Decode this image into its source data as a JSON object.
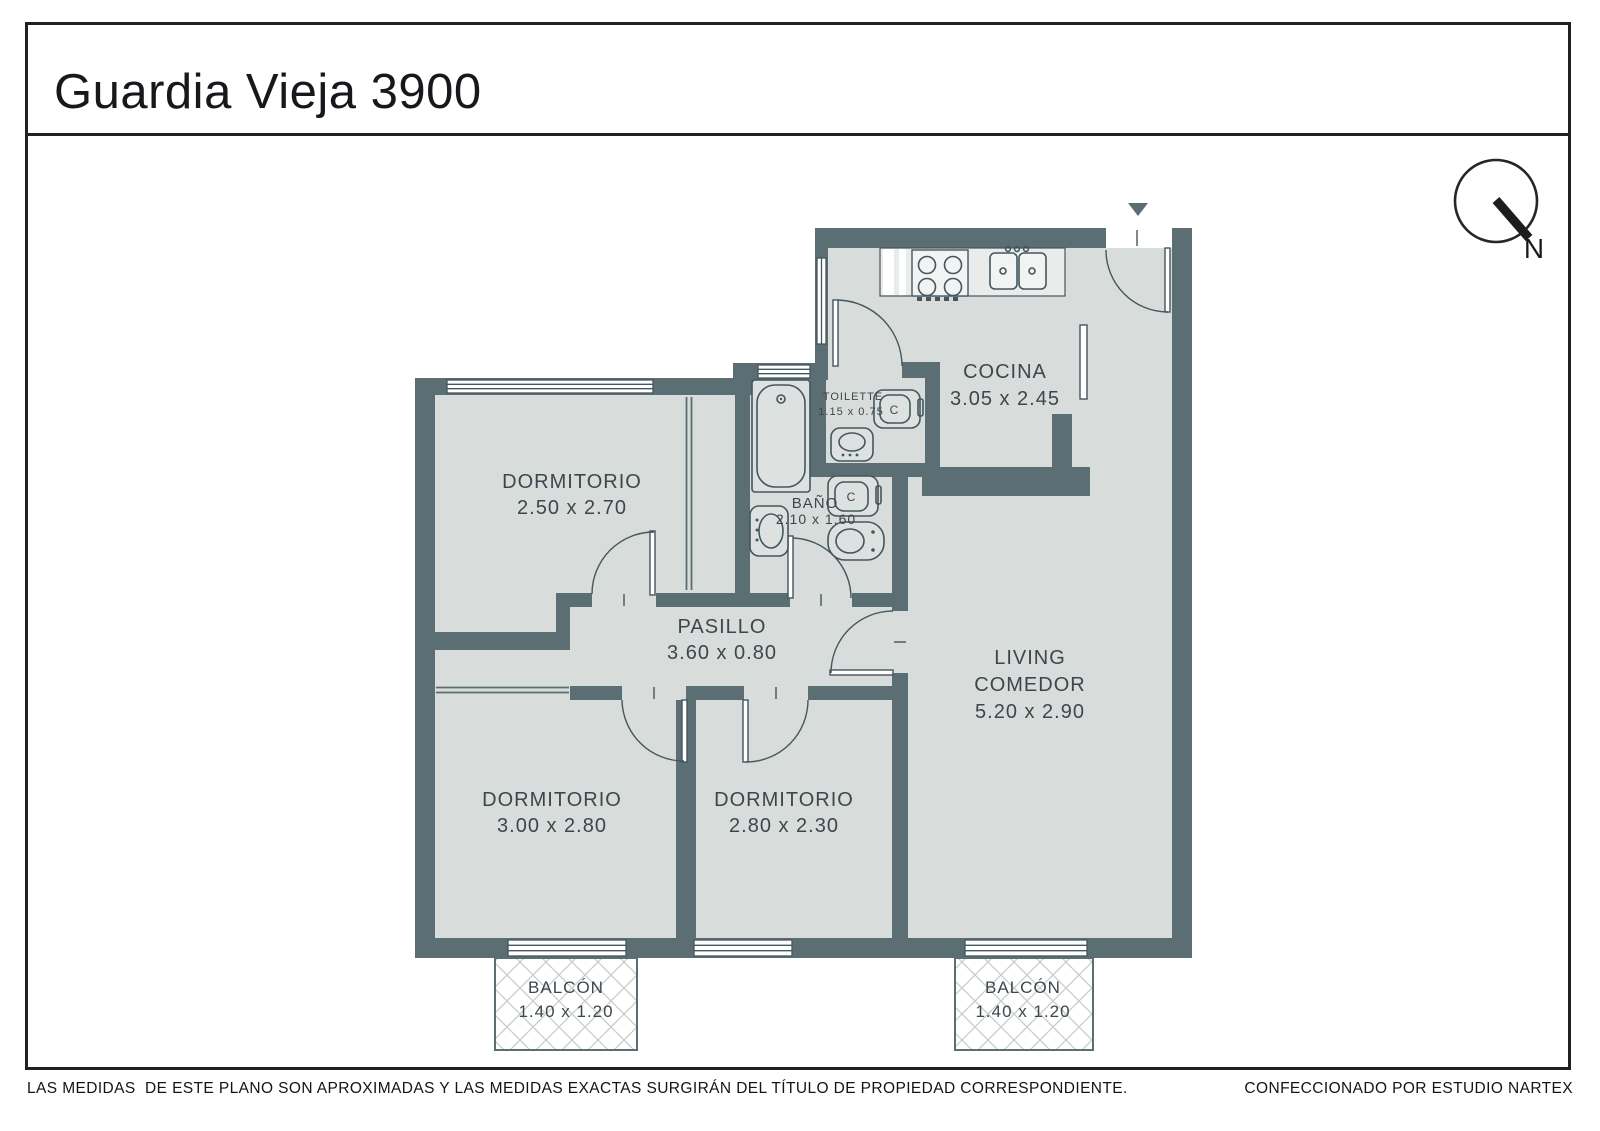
{
  "header": {
    "title": "Guardia Vieja 3900"
  },
  "compass": {
    "north_label": "N"
  },
  "plan": {
    "rooms": {
      "dormitorio_1": {
        "name": "DORMITORIO",
        "dims": "2.50 x 2.70"
      },
      "cocina": {
        "name": "COCINA",
        "dims": "3.05 x 2.45"
      },
      "toilette": {
        "name": "TOILETTE",
        "dims": "1.15 x 0.75"
      },
      "bano": {
        "name": "BAÑO",
        "dims": "2.10 x 1.60"
      },
      "pasillo": {
        "name": "PASILLO",
        "dims": "3.60 x 0.80"
      },
      "living_comedor": {
        "name_line1": "LIVING",
        "name_line2": "COMEDOR",
        "dims": "5.20 x 2.90"
      },
      "dormitorio_2": {
        "name": "DORMITORIO",
        "dims": "3.00 x 2.80"
      },
      "dormitorio_3": {
        "name": "DORMITORIO",
        "dims": "2.80 x 2.30"
      },
      "balcon_left": {
        "name": "BALCÓN",
        "dims": "1.40 x 1.20"
      },
      "balcon_right": {
        "name": "BALCÓN",
        "dims": "1.40 x 1.20"
      }
    },
    "fixtures": {
      "toilet_marker": "C"
    }
  },
  "footer": {
    "disclaimer": "LAS MEDIDAS  DE ESTE PLANO SON APROXIMADAS Y LAS MEDIDAS EXACTAS SURGIRÁN DEL TÍTULO DE PROPIEDAD CORRESPONDIENTE.",
    "credit": "CONFECCIONADO POR ESTUDIO NARTEX"
  },
  "colors": {
    "wall": "#5b6e74",
    "floor": "#d8dddb",
    "line": "#44565e",
    "label_text": "#3c474d",
    "ink": "#1b1b1f"
  }
}
